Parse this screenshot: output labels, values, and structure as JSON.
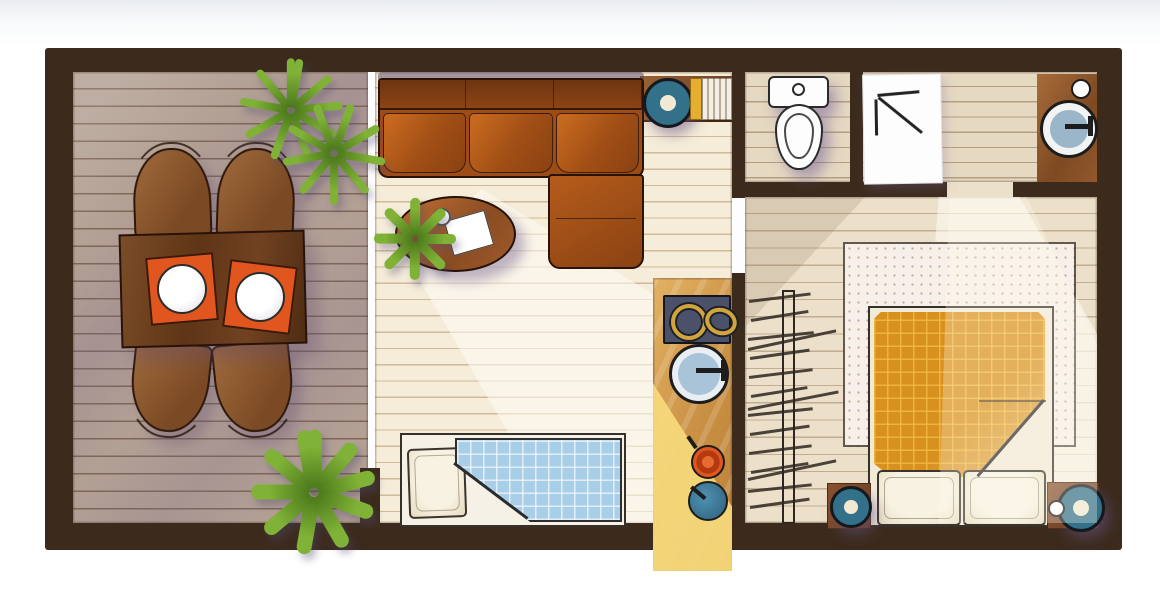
{
  "scene": {
    "description": "hand-drawn top-view apartment floor plan illustration, no text labels",
    "rooms": [
      {
        "name": "terrace",
        "floor": "wood-deck",
        "items": [
          "dining-table",
          "orange-placemat-with-plate",
          "orange-placemat-with-plate",
          "chair",
          "chair",
          "chair",
          "chair",
          "potted-plant",
          "potted-plant"
        ]
      },
      {
        "name": "living-room",
        "floor": "light-plank",
        "items": [
          "l-shaped-leather-sofa",
          "round-coffee-table",
          "paper-sheet",
          "cup",
          "small-plant",
          "single-futon-with-blue-checked-blanket",
          "pillow",
          "wall-shelf",
          "speaker",
          "books"
        ]
      },
      {
        "name": "kitchen-strip",
        "floor": "wood-counter",
        "items": [
          "two-burner-stove",
          "round-sink-with-faucet",
          "orange-pan",
          "teal-pan"
        ]
      },
      {
        "name": "bathroom",
        "floor": "light-plank",
        "items": [
          "toilet",
          "shower-mat",
          "wood-vanity",
          "round-basin",
          "soap-dish"
        ]
      },
      {
        "name": "bedroom",
        "floor": "light-plank",
        "items": [
          "radiator",
          "dotted-rug",
          "double-bed",
          "orange-checked-duvet",
          "pillow",
          "pillow",
          "nightstand-with-speaker",
          "nightstand-with-speaker"
        ]
      }
    ],
    "doors": [
      "terrace-sliding-door",
      "bedroom-door",
      "bathroom-door"
    ]
  },
  "palette": {
    "wall": "#3c2b1d",
    "deck": "#b3a094",
    "living_floor": "#f5ecd9",
    "bath_floor": "#e6d9c2",
    "bedroom_floor": "#ece0ca",
    "kitchen_wood": "#c98f42",
    "kitchen_light": "#f7db7c",
    "stove": "#4b5168",
    "brass": "#d2a43c",
    "sink_blue": "#a9c4d8",
    "teal": "#33708a",
    "orange": "#e0561e",
    "duvet": "#d8901e",
    "blanket": "#a9cee8",
    "rug": "#f7efe9",
    "plant": "#7fb236",
    "plant_dark": "#4e7a1c",
    "white": "#fdfdfd",
    "sketch": "#2b2b2b"
  }
}
